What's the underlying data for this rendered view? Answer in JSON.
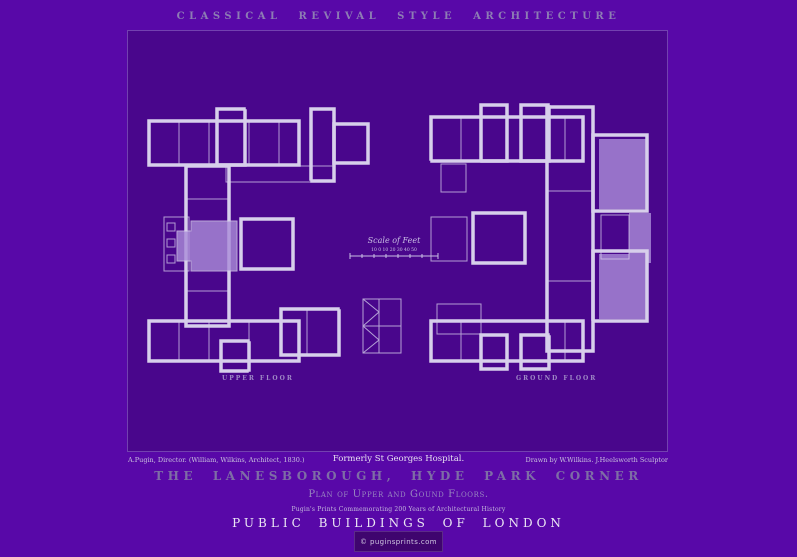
{
  "header": {
    "series_title": "CLASSICAL REVIVAL STYLE ARCHITECTURE"
  },
  "drawing": {
    "scale": {
      "label": "Scale of Feet",
      "numbers": "10 0 10 20 30 40 50"
    },
    "plans": [
      {
        "label": "UPPER FLOOR"
      },
      {
        "label": "GROUND FLOOR"
      }
    ]
  },
  "captions": {
    "left": "A.Pugin, Director. (William, Wilkins, Architect, 1830.)",
    "center": "Formerly St Georges Hospital.",
    "right": "Drawn by W.Wilkins. J.Heelsworth Sculptor"
  },
  "footer": {
    "building_title": "THE LANESBOROUGH, HYDE PARK CORNER",
    "plan_subtitle": "Plan of Upper and Gound Floors.",
    "commemoration": "Pugin's Prints Commemorating 200 Years of Architectural History",
    "series": "PUBLIC BUILDINGS OF LONDON",
    "credit": "© puginsprints.com"
  },
  "colors": {
    "background": "#5808a8",
    "panel": "#49068c",
    "plan_ink": "#d7cfeb",
    "room_fill": "#ab8ed9",
    "title_ink": "#7e6da6",
    "footer_ink": "#ebe7f4"
  }
}
